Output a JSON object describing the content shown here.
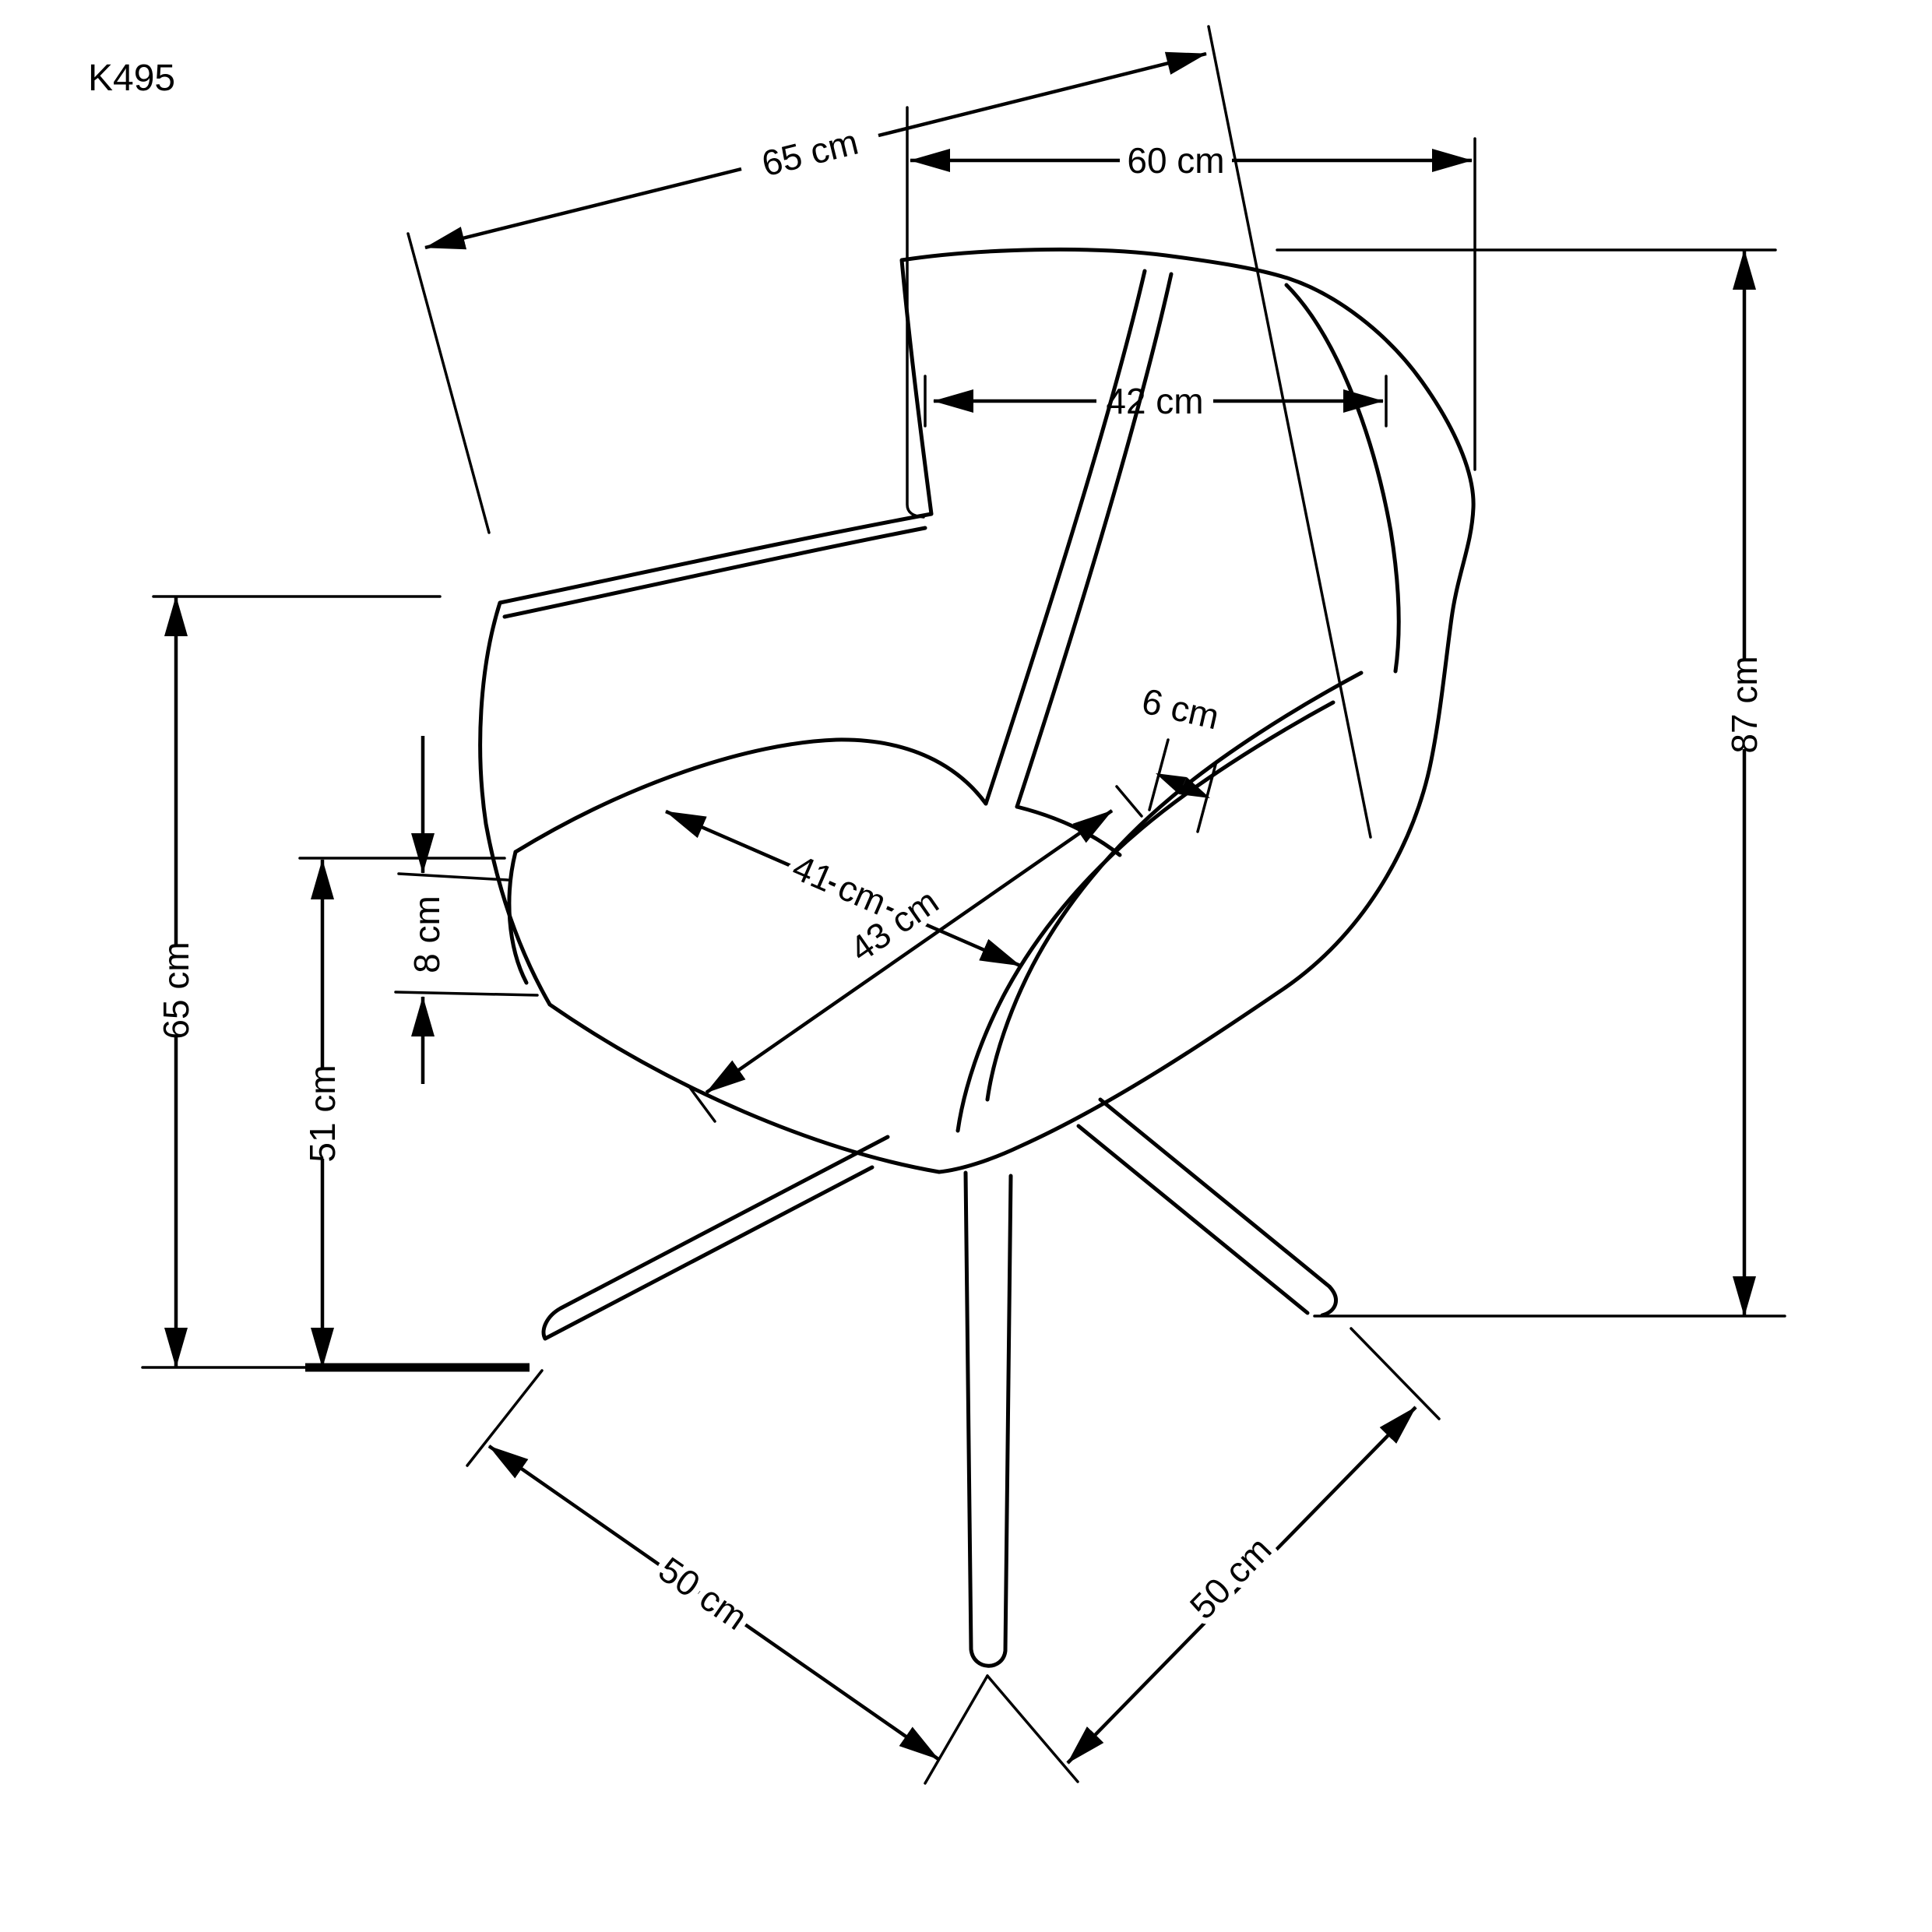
{
  "labels": {
    "model": "K495",
    "diagonal_depth": "65 cm",
    "overall_width": "60 cm",
    "backrest_width": "42 cm",
    "shell_rim_width": "6 cm",
    "overall_height": "87 cm",
    "armrest_height": "65 cm",
    "seat_cushion_thickness": "8 cm",
    "seat_height": "51 cm",
    "seat_depth": "41 cm",
    "seat_width": "43 cm",
    "base_span_left": "50 cm",
    "base_span_right": "50 cm"
  },
  "page": {
    "background_color": "#ffffff",
    "line_color": "#000000",
    "drawing_type": "chair dimension drawing"
  }
}
